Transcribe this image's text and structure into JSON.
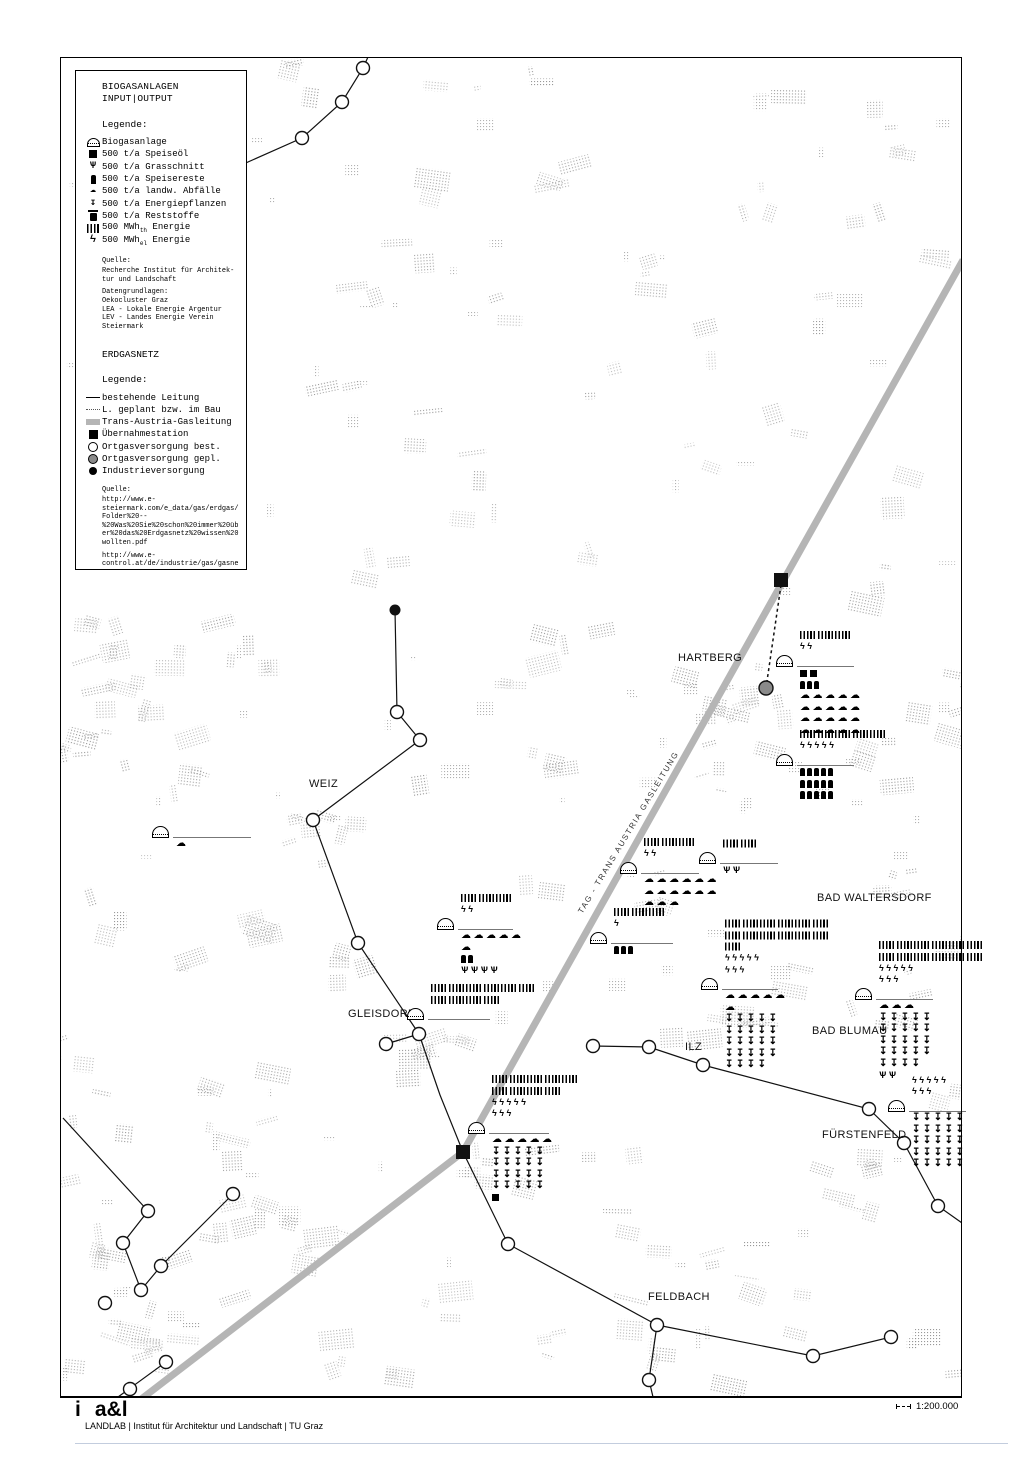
{
  "legend_panel": {
    "title1": "BIOGASANLAGEN",
    "title2": "INPUT|OUTPUT",
    "biogas": {
      "legende_label": "Legende:",
      "items": [
        {
          "icon": "dome",
          "label": "Biogasanlage"
        },
        {
          "icon": "sq",
          "label": "500 t/a Speiseöl"
        },
        {
          "icon": "grass",
          "label": "500 t/a Grasschnitt"
        },
        {
          "icon": "bottle",
          "label": "500 t/a Speisereste"
        },
        {
          "icon": "pile",
          "label": "500 t/a landw. Abfälle"
        },
        {
          "icon": "arrow",
          "label": "500 t/a Energiepflanzen"
        },
        {
          "icon": "trash",
          "label": "500 t/a Reststoffe"
        },
        {
          "icon": "th",
          "label": "500 MWh",
          "sub": "th",
          "label2": " Energie"
        },
        {
          "icon": "el",
          "label": "500 MWh",
          "sub": "el",
          "label2": " Energie"
        }
      ],
      "quelle_label": "Quelle:",
      "quelle_lines": [
        "Recherche Institut für Architek-",
        "tur und Landschaft"
      ],
      "daten_label": "Datengrundlagen:",
      "daten_lines": [
        "Oekocluster Graz",
        "LEA - Lokale Energie Argentur",
        "LEV - Landes Energie Verein",
        "Steiermark"
      ]
    },
    "erdgas": {
      "title": "ERDGASNETZ",
      "legende_label": "Legende:",
      "items": [
        {
          "icon": "line-solid",
          "label": "bestehende Leitung"
        },
        {
          "icon": "line-dotted",
          "label": "L. geplant bzw. im Bau"
        },
        {
          "icon": "line-tag",
          "label": "Trans-Austria-Gasleitung"
        },
        {
          "icon": "station",
          "label": "Übernahmestation"
        },
        {
          "icon": "circle-open",
          "label": "Ortgasversorgung best."
        },
        {
          "icon": "circle-gray",
          "label": "Ortgasversorgung gepl."
        },
        {
          "icon": "dot-black",
          "label": "Industrieversorgung"
        }
      ],
      "quelle_label": "Quelle:",
      "url1_lines": [
        "http://www.e-",
        "steiermark.com/e_data/gas/erdgas/",
        "Folder%20--",
        "%20Was%20Sie%20schon%20immer%20üb",
        "er%20das%20Erdgasnetz%20wissen%20",
        "wollten.pdf"
      ],
      "url2_lines": [
        "http://www.e-",
        "control.at/de/industrie/gas/gasne",
        "tz"
      ]
    }
  },
  "map": {
    "colors": {
      "tag_line": "#b5b5b5",
      "network_line": "#111111",
      "planned_node_fill": "#8a8a8a",
      "stipple": "#8f8f8f"
    },
    "tag_label": {
      "text": "TAG - TRANS AUSTRIA GASLEITUNG"
    },
    "towns": [
      {
        "name": "WEIZ",
        "x": 309,
        "y": 778
      },
      {
        "name": "HARTBERG",
        "x": 678,
        "y": 652
      },
      {
        "name": "GLEISDORF",
        "x": 348,
        "y": 1008
      },
      {
        "name": "ILZ",
        "x": 685,
        "y": 1041
      },
      {
        "name": "BAD WALTERSDORF",
        "x": 817,
        "y": 892
      },
      {
        "name": "BAD BLUMAU",
        "x": 812,
        "y": 1025
      },
      {
        "name": "FÜRSTENFELD",
        "x": 822,
        "y": 1129
      },
      {
        "name": "FELDBACH",
        "x": 648,
        "y": 1291
      }
    ],
    "network": {
      "tag_line": [
        [
          963,
          260
        ],
        [
          463,
          1152
        ],
        [
          140,
          1400
        ]
      ],
      "lines": [
        [
          [
            230,
            170
          ],
          [
            302,
            138
          ],
          [
            342,
            102
          ],
          [
            363,
            68
          ],
          [
            368,
            57
          ]
        ],
        [
          [
            395,
            610
          ],
          [
            397,
            712
          ],
          [
            420,
            740
          ],
          [
            313,
            820
          ],
          [
            358,
            943
          ],
          [
            413,
            1025
          ],
          [
            419,
            1034
          ]
        ],
        [
          [
            419,
            1034
          ],
          [
            386,
            1044
          ]
        ],
        [
          [
            419,
            1034
          ],
          [
            440,
            1095
          ],
          [
            463,
            1152
          ],
          [
            508,
            1244
          ],
          [
            657,
            1325
          ]
        ],
        [
          [
            657,
            1325
          ],
          [
            649,
            1380
          ],
          [
            653,
            1397
          ]
        ],
        [
          [
            657,
            1325
          ],
          [
            813,
            1356
          ],
          [
            891,
            1337
          ]
        ],
        [
          [
            593,
            1046
          ],
          [
            649,
            1047
          ],
          [
            703,
            1065
          ],
          [
            869,
            1109
          ],
          [
            904,
            1143
          ],
          [
            938,
            1206
          ],
          [
            962,
            1223
          ]
        ],
        [
          [
            63,
            1118
          ],
          [
            148,
            1211
          ],
          [
            123,
            1243
          ],
          [
            141,
            1290
          ],
          [
            161,
            1266
          ],
          [
            233,
            1194
          ]
        ],
        [
          [
            166,
            1362
          ],
          [
            118,
            1397
          ]
        ]
      ],
      "dashed_lines": [
        [
          [
            781,
            585
          ],
          [
            766,
            688
          ]
        ]
      ],
      "nodes_open": [
        [
          302,
          138
        ],
        [
          342,
          102
        ],
        [
          363,
          68
        ],
        [
          397,
          712
        ],
        [
          420,
          740
        ],
        [
          313,
          820
        ],
        [
          358,
          943
        ],
        [
          419,
          1034
        ],
        [
          386,
          1044
        ],
        [
          508,
          1244
        ],
        [
          657,
          1325
        ],
        [
          649,
          1380
        ],
        [
          813,
          1356
        ],
        [
          891,
          1337
        ],
        [
          593,
          1046
        ],
        [
          649,
          1047
        ],
        [
          703,
          1065
        ],
        [
          869,
          1109
        ],
        [
          904,
          1143
        ],
        [
          938,
          1206
        ],
        [
          148,
          1211
        ],
        [
          123,
          1243
        ],
        [
          141,
          1290
        ],
        [
          161,
          1266
        ],
        [
          233,
          1194
        ],
        [
          105,
          1303
        ],
        [
          166,
          1362
        ],
        [
          130,
          1389
        ]
      ],
      "nodes_planned": [
        [
          766,
          688
        ]
      ],
      "nodes_industry": [
        [
          395,
          610
        ]
      ],
      "stations": [
        [
          781,
          580
        ],
        [
          463,
          1152
        ]
      ]
    },
    "plants": [
      {
        "x": 152,
        "y": 826,
        "lw": 78,
        "out": [],
        "in": [
          [
            "pile",
            1
          ]
        ]
      },
      {
        "x": 437,
        "y": 918,
        "lw": 55,
        "out": [
          [
            "th",
            3
          ],
          [
            "el",
            2
          ]
        ],
        "in": [
          [
            "pile",
            5
          ],
          [
            "pile",
            1
          ],
          [
            "bottle",
            2
          ],
          [
            "grass",
            4
          ]
        ]
      },
      {
        "x": 407,
        "y": 1008,
        "lw": 62,
        "out": [
          [
            "th",
            6
          ],
          [
            "th",
            4
          ]
        ],
        "in": []
      },
      {
        "x": 468,
        "y": 1122,
        "lw": 60,
        "out": [
          [
            "th",
            5
          ],
          [
            "th",
            4
          ],
          [
            "el",
            5
          ],
          [
            "el",
            3
          ]
        ],
        "in": [
          [
            "pile",
            5
          ],
          [
            "arrow",
            5
          ],
          [
            "arrow",
            5
          ],
          [
            "arrow",
            5
          ],
          [
            "arrow",
            5
          ],
          [
            "sq",
            1
          ]
        ]
      },
      {
        "x": 620,
        "y": 862,
        "lw": 58,
        "out": [
          [
            "th",
            3
          ],
          [
            "el",
            2
          ]
        ],
        "in": [
          [
            "pile",
            6
          ],
          [
            "pile",
            6
          ],
          [
            "pile",
            3
          ]
        ]
      },
      {
        "x": 699,
        "y": 852,
        "lw": 58,
        "out": [
          [
            "th",
            2
          ]
        ],
        "in": [
          [
            "grass",
            2
          ]
        ]
      },
      {
        "x": 590,
        "y": 932,
        "lw": 62,
        "out": [
          [
            "th",
            3
          ],
          [
            "el",
            1
          ]
        ],
        "in": [
          [
            "bottle",
            3
          ]
        ]
      },
      {
        "x": 701,
        "y": 978,
        "lw": 56,
        "out": [
          [
            "th",
            6
          ],
          [
            "th",
            6
          ],
          [
            "th",
            1
          ],
          [
            "el",
            5
          ],
          [
            "el",
            3
          ]
        ],
        "in": [
          [
            "pile",
            5
          ],
          [
            "pile",
            1
          ],
          [
            "arrow",
            5
          ],
          [
            "arrow",
            5
          ],
          [
            "arrow",
            5
          ],
          [
            "arrow",
            5
          ],
          [
            "arrow",
            4
          ]
        ]
      },
      {
        "x": 855,
        "y": 988,
        "lw": 57,
        "out": [
          [
            "th",
            6
          ],
          [
            "th",
            6
          ],
          [
            "el",
            5
          ],
          [
            "el",
            3
          ]
        ],
        "in": [
          [
            "pile",
            3
          ],
          [
            "arrow",
            5
          ],
          [
            "arrow",
            5
          ],
          [
            "arrow",
            5
          ],
          [
            "arrow",
            5
          ],
          [
            "arrow",
            4
          ],
          [
            "grass",
            2
          ]
        ]
      },
      {
        "x": 888,
        "y": 1100,
        "lw": 57,
        "out": [
          [
            "el",
            5
          ],
          [
            "el",
            3
          ]
        ],
        "in": [
          [
            "arrow",
            5
          ],
          [
            "arrow",
            5
          ],
          [
            "arrow",
            5
          ],
          [
            "arrow",
            5
          ],
          [
            "arrow",
            5
          ]
        ]
      },
      {
        "x": 776,
        "y": 655,
        "lw": 57,
        "out": [
          [
            "th",
            3
          ],
          [
            "el",
            2
          ]
        ],
        "in": [
          [
            "sq",
            2
          ],
          [
            "bottle",
            3
          ],
          [
            "pile",
            5
          ],
          [
            "pile",
            5
          ],
          [
            "pile",
            5
          ],
          [
            "pile",
            5
          ]
        ]
      },
      {
        "x": 776,
        "y": 754,
        "lw": 57,
        "out": [
          [
            "th",
            5
          ],
          [
            "el",
            5
          ]
        ],
        "in": [
          [
            "bottle",
            5
          ],
          [
            "bottle",
            5
          ],
          [
            "bottle",
            5
          ]
        ]
      }
    ]
  },
  "footer": {
    "logo_i": "i",
    "logo_al": "a&l",
    "credit": "LANDLAB | Institut für Architektur und Landschaft | TU Graz",
    "scale": "1:200.000"
  }
}
